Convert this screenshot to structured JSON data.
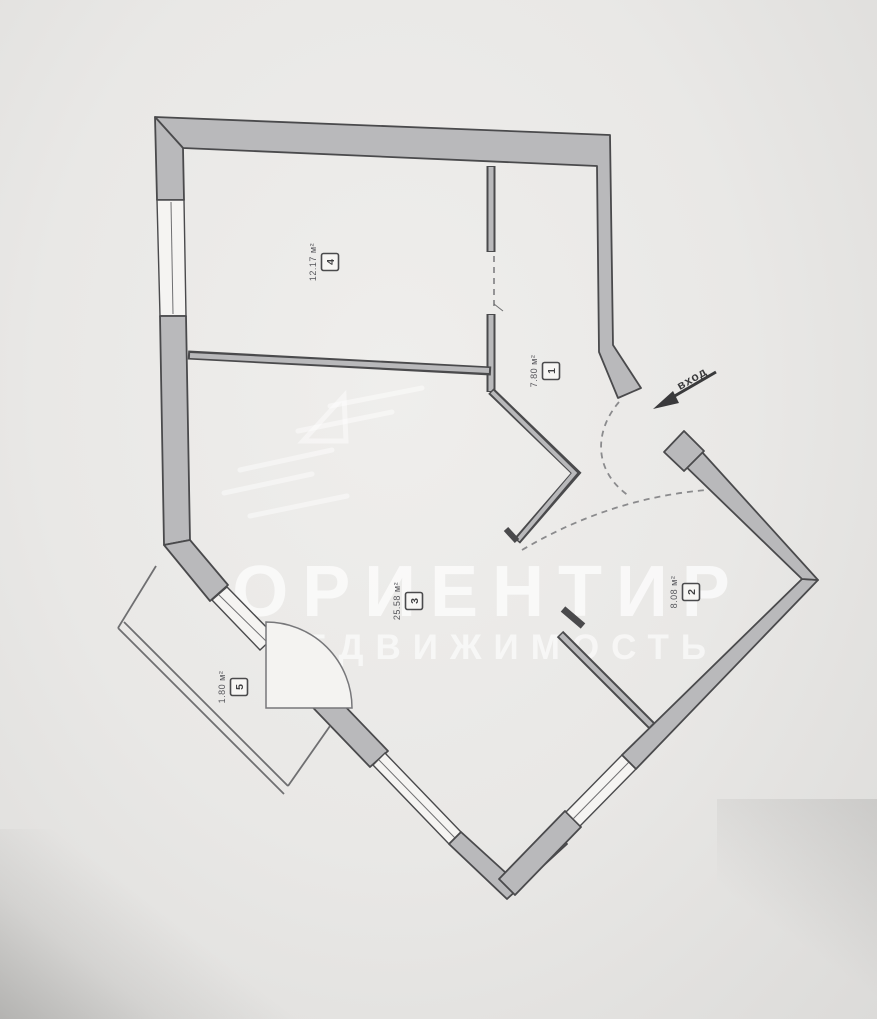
{
  "watermark": {
    "line1": "ОРИЕНТИР",
    "line2": "НЕДВИЖИМОСТЬ"
  },
  "entrance": {
    "label": "вход"
  },
  "rooms": [
    {
      "number": "1",
      "area": "7.80 м²"
    },
    {
      "number": "2",
      "area": "8.08 м²"
    },
    {
      "number": "3",
      "area": "25.58 м²"
    },
    {
      "number": "4",
      "area": "12.17 м²"
    },
    {
      "number": "5",
      "area": "1.80 м²"
    }
  ],
  "colors": {
    "paper": "#e9e8e6",
    "paper_edge": "#dcdbd9",
    "wall_fill": "#b9b9bb",
    "wall_stroke": "#4a4a4c",
    "thin_line": "#6f6f71",
    "dash_line": "#8b8b8d",
    "label_ink": "#3f3f41",
    "area_ink": "#55555a",
    "watermark": "#ffffff"
  }
}
